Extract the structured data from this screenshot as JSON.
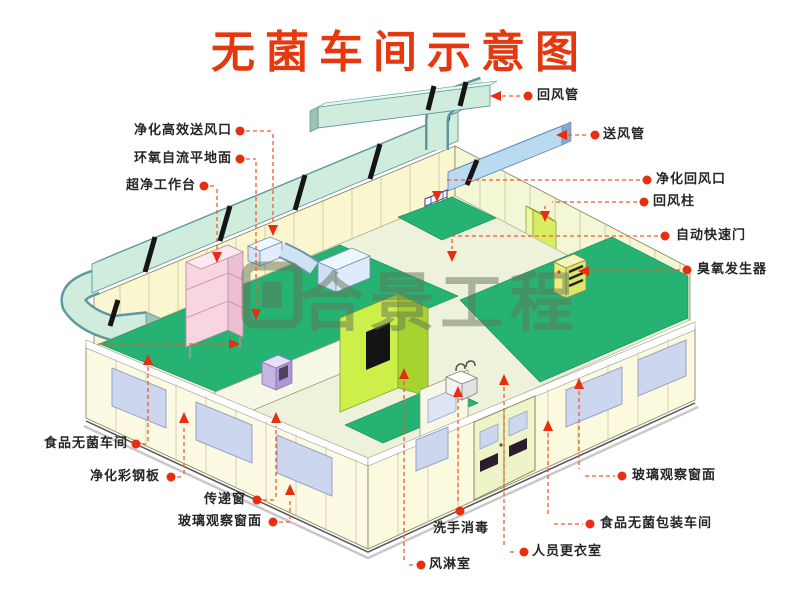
{
  "title": "无菌车间示意图",
  "watermark": {
    "text": "合景工程"
  },
  "callouts": {
    "hepa_supply_outlet": {
      "label": "净化高效送风口"
    },
    "epoxy_floor": {
      "label": "环氧自流平地面"
    },
    "clean_workbench": {
      "label": "超净工作台"
    },
    "food_sterile_workshop": {
      "label": "食品无菌车间"
    },
    "purify_steel_panel": {
      "label": "净化彩钢板"
    },
    "transfer_window": {
      "label": "传递窗"
    },
    "glass_window_left": {
      "label": "玻璃观察窗面"
    },
    "return_duct": {
      "label": "回风管"
    },
    "supply_duct": {
      "label": "送风管"
    },
    "purify_return_outlet": {
      "label": "净化回风口"
    },
    "return_air_column": {
      "label": "回风柱"
    },
    "auto_rapid_door": {
      "label": "自动快速门"
    },
    "ozone_generator": {
      "label": "臭氧发生器"
    },
    "glass_window_right": {
      "label": "玻璃观察窗面"
    },
    "food_packing_workshop": {
      "label": "食品无菌包装车间"
    },
    "hand_wash": {
      "label": "洗手消毒"
    },
    "changing_room": {
      "label": "人员更衣室"
    },
    "air_shower": {
      "label": "风淋室"
    }
  },
  "colors": {
    "title_red": "#e5380e",
    "callout_dot_red": "#e82e10",
    "callout_dash_orange": "#f25a32",
    "duct_cyan": "#cfecdc",
    "supply_duct_blue": "#badaf2",
    "floor_green": "#25b273",
    "wall_cream": "#faf6d0",
    "air_shower_green": "#cdef49",
    "window_blue": "#ccd6ee",
    "workbench_pink": "#f7d6e2",
    "watermark_olive": "#64735a"
  }
}
